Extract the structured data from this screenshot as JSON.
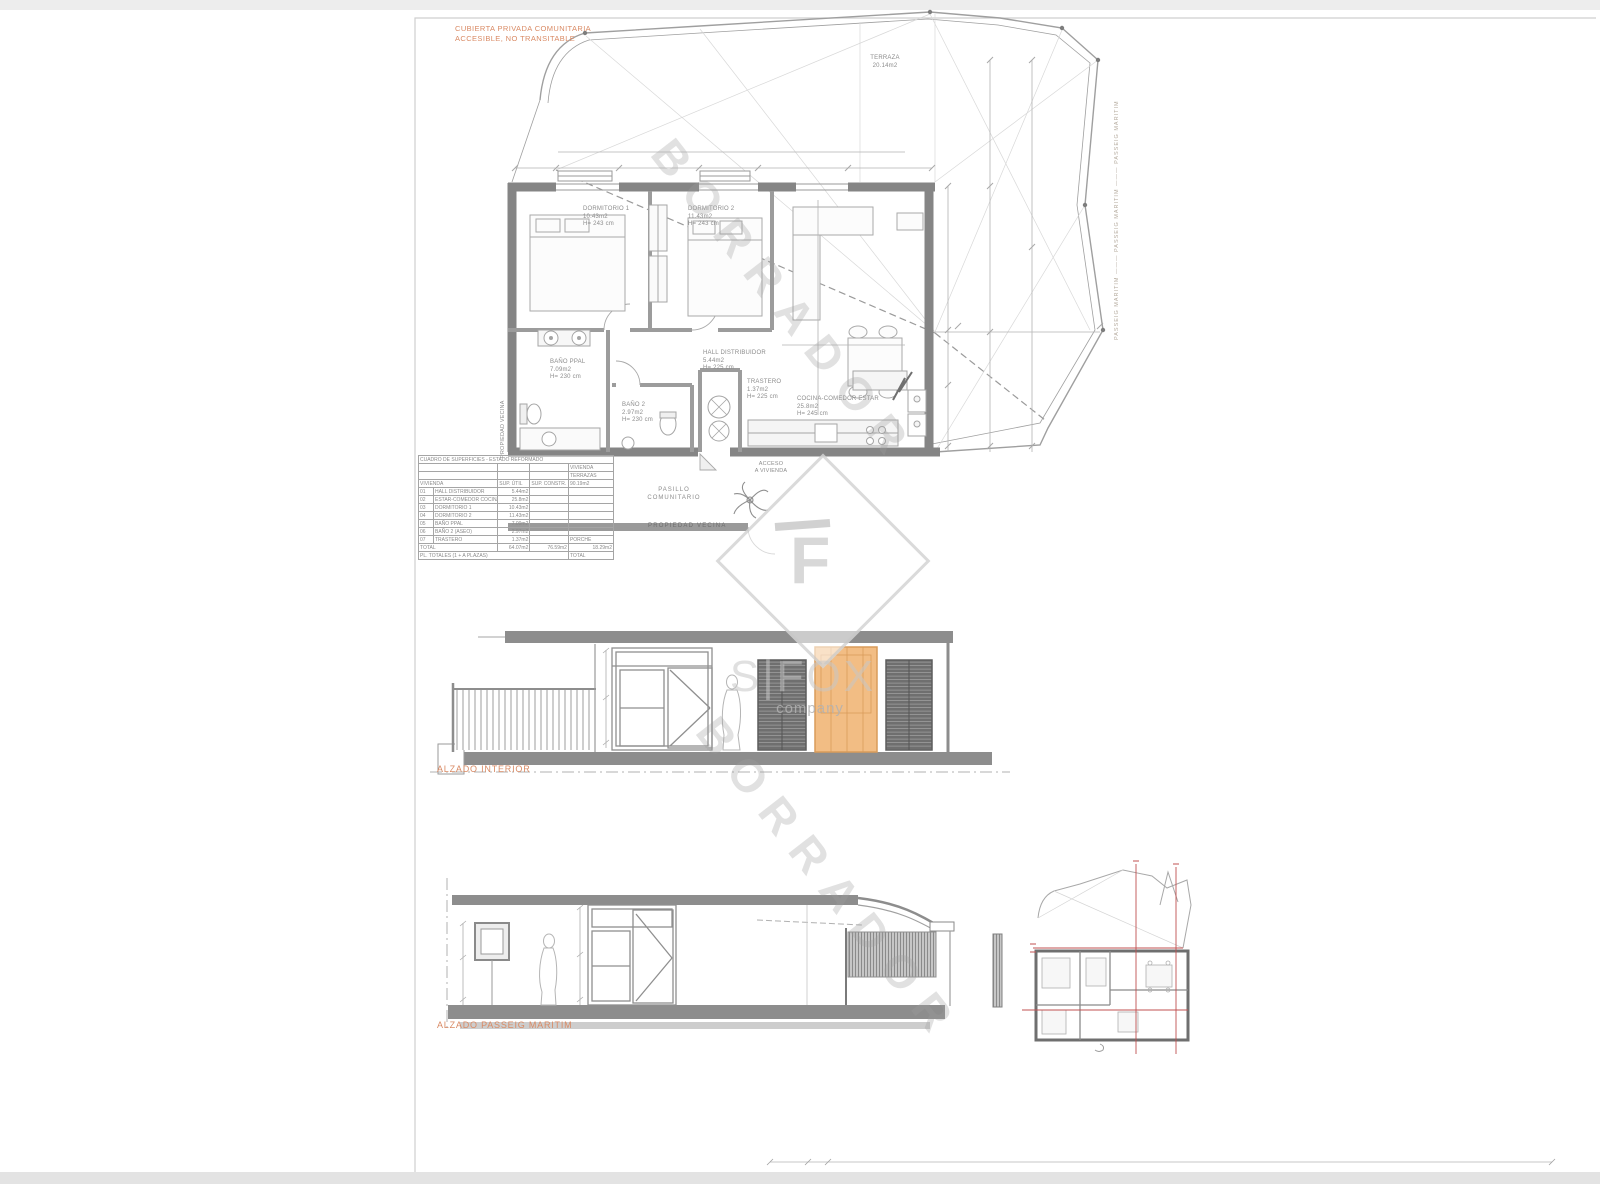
{
  "plan": {
    "roof_note_line1": "CUBIERTA PRIVADA COMUNITARIA",
    "roof_note_line2": "ACCESIBLE, NO TRANSITABLE",
    "terraza_label": "TERRAZA",
    "terraza_area": "20.14m2",
    "rooms": [
      {
        "label": "DORMITORIO 1",
        "area": "10.43m2",
        "height": "H= 243 cm"
      },
      {
        "label": "DORMITORIO 2",
        "area": "11.43m2",
        "height": "H= 243 cm"
      },
      {
        "label": "BAÑO PPAL",
        "area": "7.09m2",
        "height": "H= 230 cm"
      },
      {
        "label": "BAÑO 2",
        "area": "2.97m2",
        "height": "H= 230 cm"
      },
      {
        "label": "HALL DISTRIBUIDOR",
        "area": "5.44m2",
        "height": "H= 225 cm"
      },
      {
        "label": "TRASTERO",
        "area": "1.37m2",
        "height": "H= 225 cm"
      },
      {
        "label": "COCINA-COMEDOR ESTAR",
        "area": "25.8m2",
        "height": "H= 245 cm"
      }
    ],
    "pasillo_line1": "PASILLO",
    "pasillo_line2": "COMUNITARIO",
    "acceso_line1": "ACCESO",
    "acceso_line2": "A VIVIENDA",
    "propiedad_vecina_bottom": "PROPIEDAD VECINA",
    "propiedad_vecina_left": "PROPIEDAD VECINA",
    "passeig_maritim_right": "PASSEIG MARITIM ——— PASSEIG MARITIM ——— PASSEIG MARITIM"
  },
  "surface_table": {
    "title": "CUADRO DE SUPERFICIES - ESTADO REFORMADO",
    "header": {
      "section": "VIVIENDA",
      "util": "SUP. ÚTIL",
      "constr": "SUP. CONSTR.",
      "right1": "VIVIENDA",
      "right2": "TERRAZAS",
      "right3": "90.19m2"
    },
    "rows": [
      {
        "code": "01",
        "name": "HALL DISTRIBUIDOR",
        "util": "5.44m2",
        "right": ""
      },
      {
        "code": "02",
        "name": "ESTAR-COMEDOR COCINA",
        "util": "25.8m2",
        "right": ""
      },
      {
        "code": "03",
        "name": "DORMITORIO 1",
        "util": "10.43m2",
        "right": ""
      },
      {
        "code": "04",
        "name": "DORMITORIO 2",
        "util": "11.43m2",
        "right": ""
      },
      {
        "code": "05",
        "name": "BAÑO PPAL",
        "util": "7.09m2",
        "right": ""
      },
      {
        "code": "06",
        "name": "BAÑO 2 (ASEO)",
        "util": "2.97m2",
        "right": ""
      },
      {
        "code": "07",
        "name": "TRASTERO",
        "util": "1.37m2",
        "right": "PORCHE"
      }
    ],
    "total": {
      "label": "TOTAL",
      "util": "64.07m2",
      "constr": "76.59m2",
      "right": "18.29m2"
    },
    "footer": {
      "label": "PL. TOTALES (1 + A PLAZAS)",
      "right": "TOTAL"
    }
  },
  "elevations": {
    "interior_label": "ALZADO INTERIOR",
    "passeig_label": "ALZADO PASSEIG MARITIM"
  },
  "watermarks": {
    "borrador": "BORRADOR",
    "brand_visible": "S|FOX",
    "brand_tagline": "company",
    "brand_monogram": "F"
  },
  "colors": {
    "accent_orange": "#d98a64",
    "highlight_door": "#f2bd84",
    "wall_gray": "#878787",
    "red_section": "#c05050",
    "watermark_gray": "#bdbdbd"
  }
}
